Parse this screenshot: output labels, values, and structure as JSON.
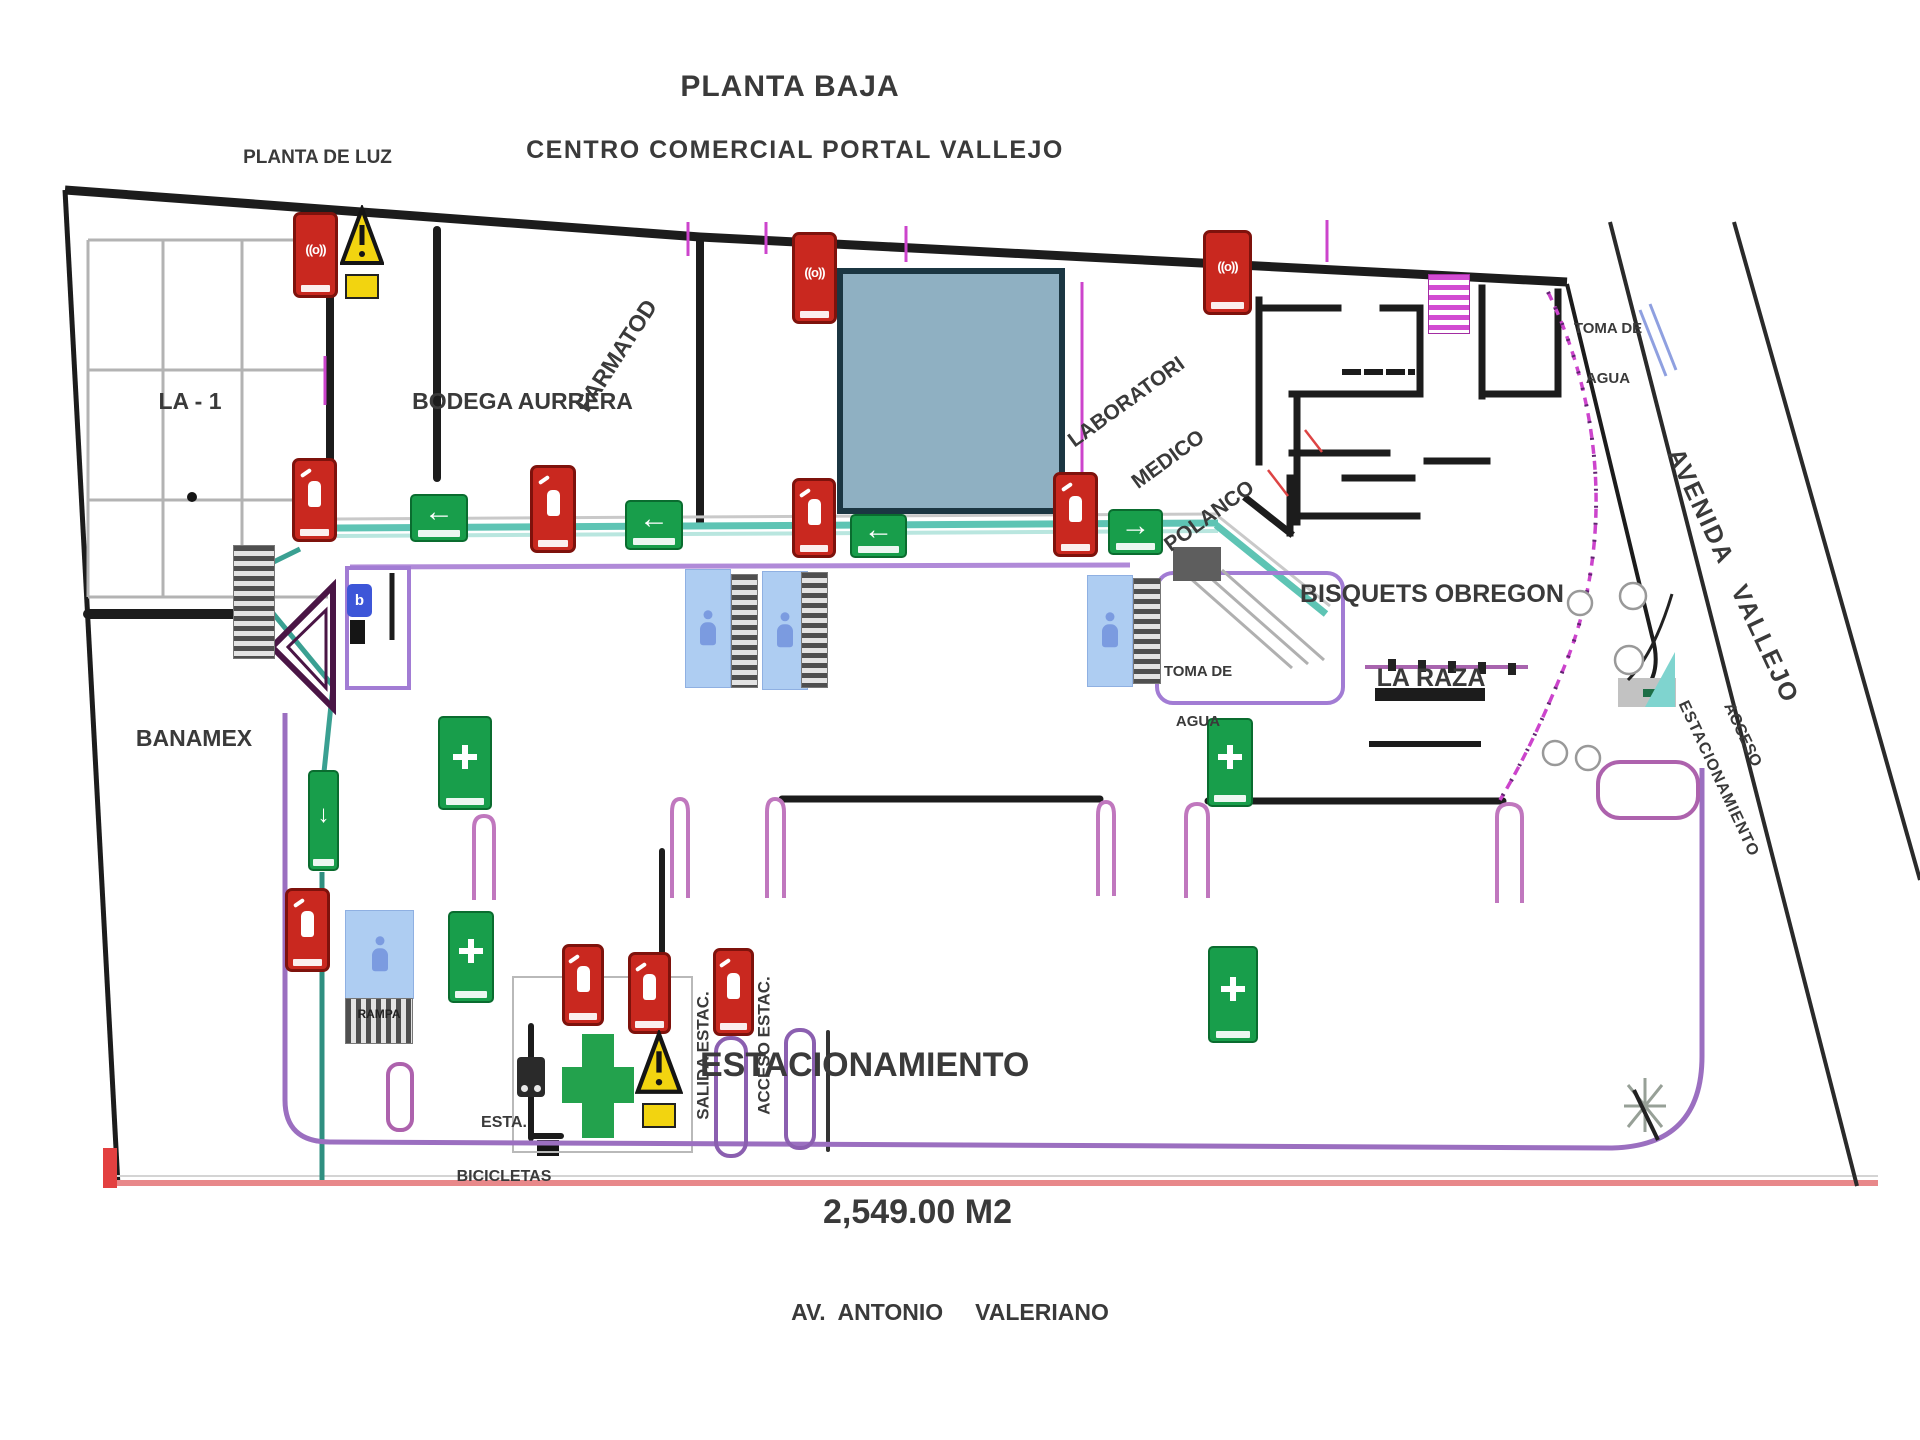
{
  "doc": {
    "title": "PLANTA BAJA",
    "subtitle": "CENTRO COMERCIAL PORTAL VALLEJO",
    "street_bottom": "AV.  ANTONIO     VALERIANO",
    "street_right": "AVENIDA   VALLEJO"
  },
  "zones": {
    "planta_de_luz": "PLANTA DE LUZ",
    "la_1": "LA - 1",
    "bodega_aurrera": "BODEGA AURRERA",
    "farmatodo": "FARMATOD",
    "laboratorio_l1": "LABORATORI",
    "laboratorio_l2": "MEDICO",
    "laboratorio_l3": "POLANCO",
    "toma_agua_l1": "TOMA DE",
    "toma_agua_l2": "AGUA",
    "bisquets_l1": "BISQUETS OBREGON",
    "bisquets_l2": "LA RAZA",
    "banamex": "BANAMEX",
    "parking_name": "ESTACIONAMIENTO",
    "parking_area": "2,549.00 M2",
    "rampa": "RAMPA",
    "bicis_l1": "ESTA.",
    "bicis_l2": "BICICLETAS",
    "salida_estac": "SALIDA ESTAC.",
    "acceso_estac": "ACCESO ESTAC.",
    "acceso_right": "ACCESO",
    "estacionamiento_right": "ESTACIONAMIENTO"
  },
  "icons": {
    "siren": "((o))",
    "exit_left": "←",
    "exit_right": "→",
    "exit_down": "↓",
    "panel": "b"
  },
  "colors": {
    "sign_red": "#c9281f",
    "sign_green": "#189e4b",
    "warn_yellow": "#f2d410",
    "corridor_teal": "#5ec4b4",
    "route_purple": "#a27cd4",
    "facade_magenta": "#cc44cc",
    "store_block_blue": "#8fb0c2",
    "restroom_blue": "#aecdf2",
    "boundary_black": "#1c1c1c",
    "sidewalk_red": "#e8888a"
  }
}
